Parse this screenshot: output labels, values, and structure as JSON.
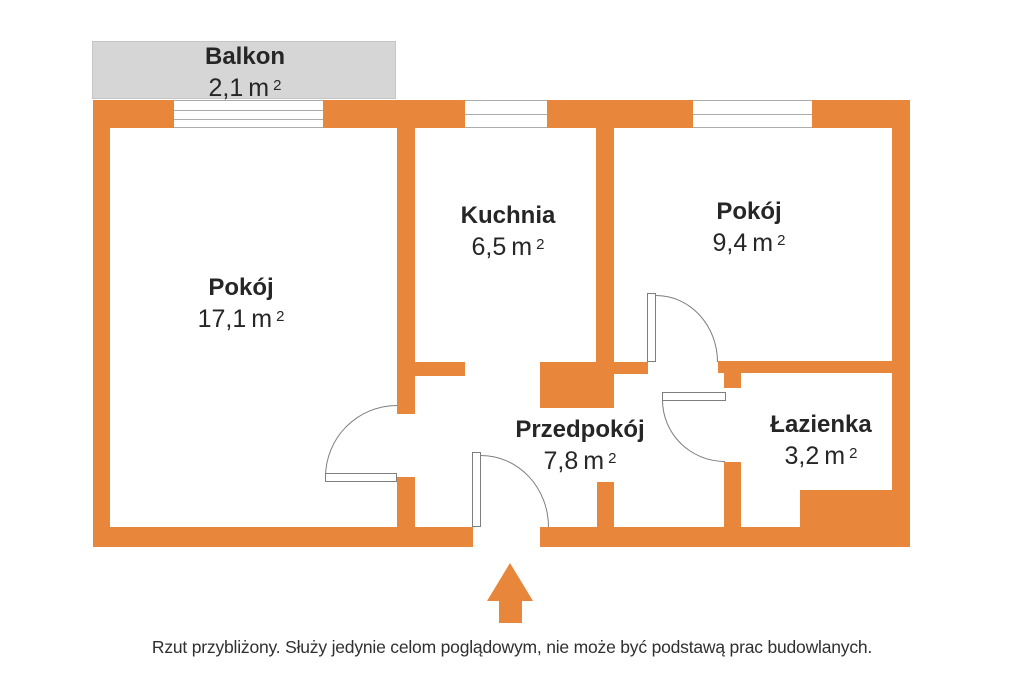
{
  "title": "Rzut mieszkania (floor plan)",
  "colors": {
    "wall": "#E8873B",
    "balcony": "#D6D6D6",
    "doorline": "#7E7E7E",
    "windowline": "#ABABAB",
    "text": "#262626",
    "caption": "#303030"
  },
  "rooms": [
    {
      "id": "balkon",
      "name": "Balkon",
      "area": "2,1",
      "unit": "m",
      "sup": "2"
    },
    {
      "id": "pokoj-1",
      "name": "Pokój",
      "area": "17,1",
      "unit": "m",
      "sup": "2"
    },
    {
      "id": "kuchnia",
      "name": "Kuchnia",
      "area": "6,5",
      "unit": "m",
      "sup": "2"
    },
    {
      "id": "pokoj-2",
      "name": "Pokój",
      "area": "9,4",
      "unit": "m",
      "sup": "2"
    },
    {
      "id": "przedpokoj",
      "name": "Przedpokój",
      "area": "7,8",
      "unit": "m",
      "sup": "2"
    },
    {
      "id": "lazienka",
      "name": "Łazienka",
      "area": "3,2",
      "unit": "m",
      "sup": "2"
    }
  ],
  "entrance_arrow": "up-arrow",
  "caption": "Rzut przybliżony. Służy jedynie celom poglądowym, nie może być podstawą prac budowlanych."
}
